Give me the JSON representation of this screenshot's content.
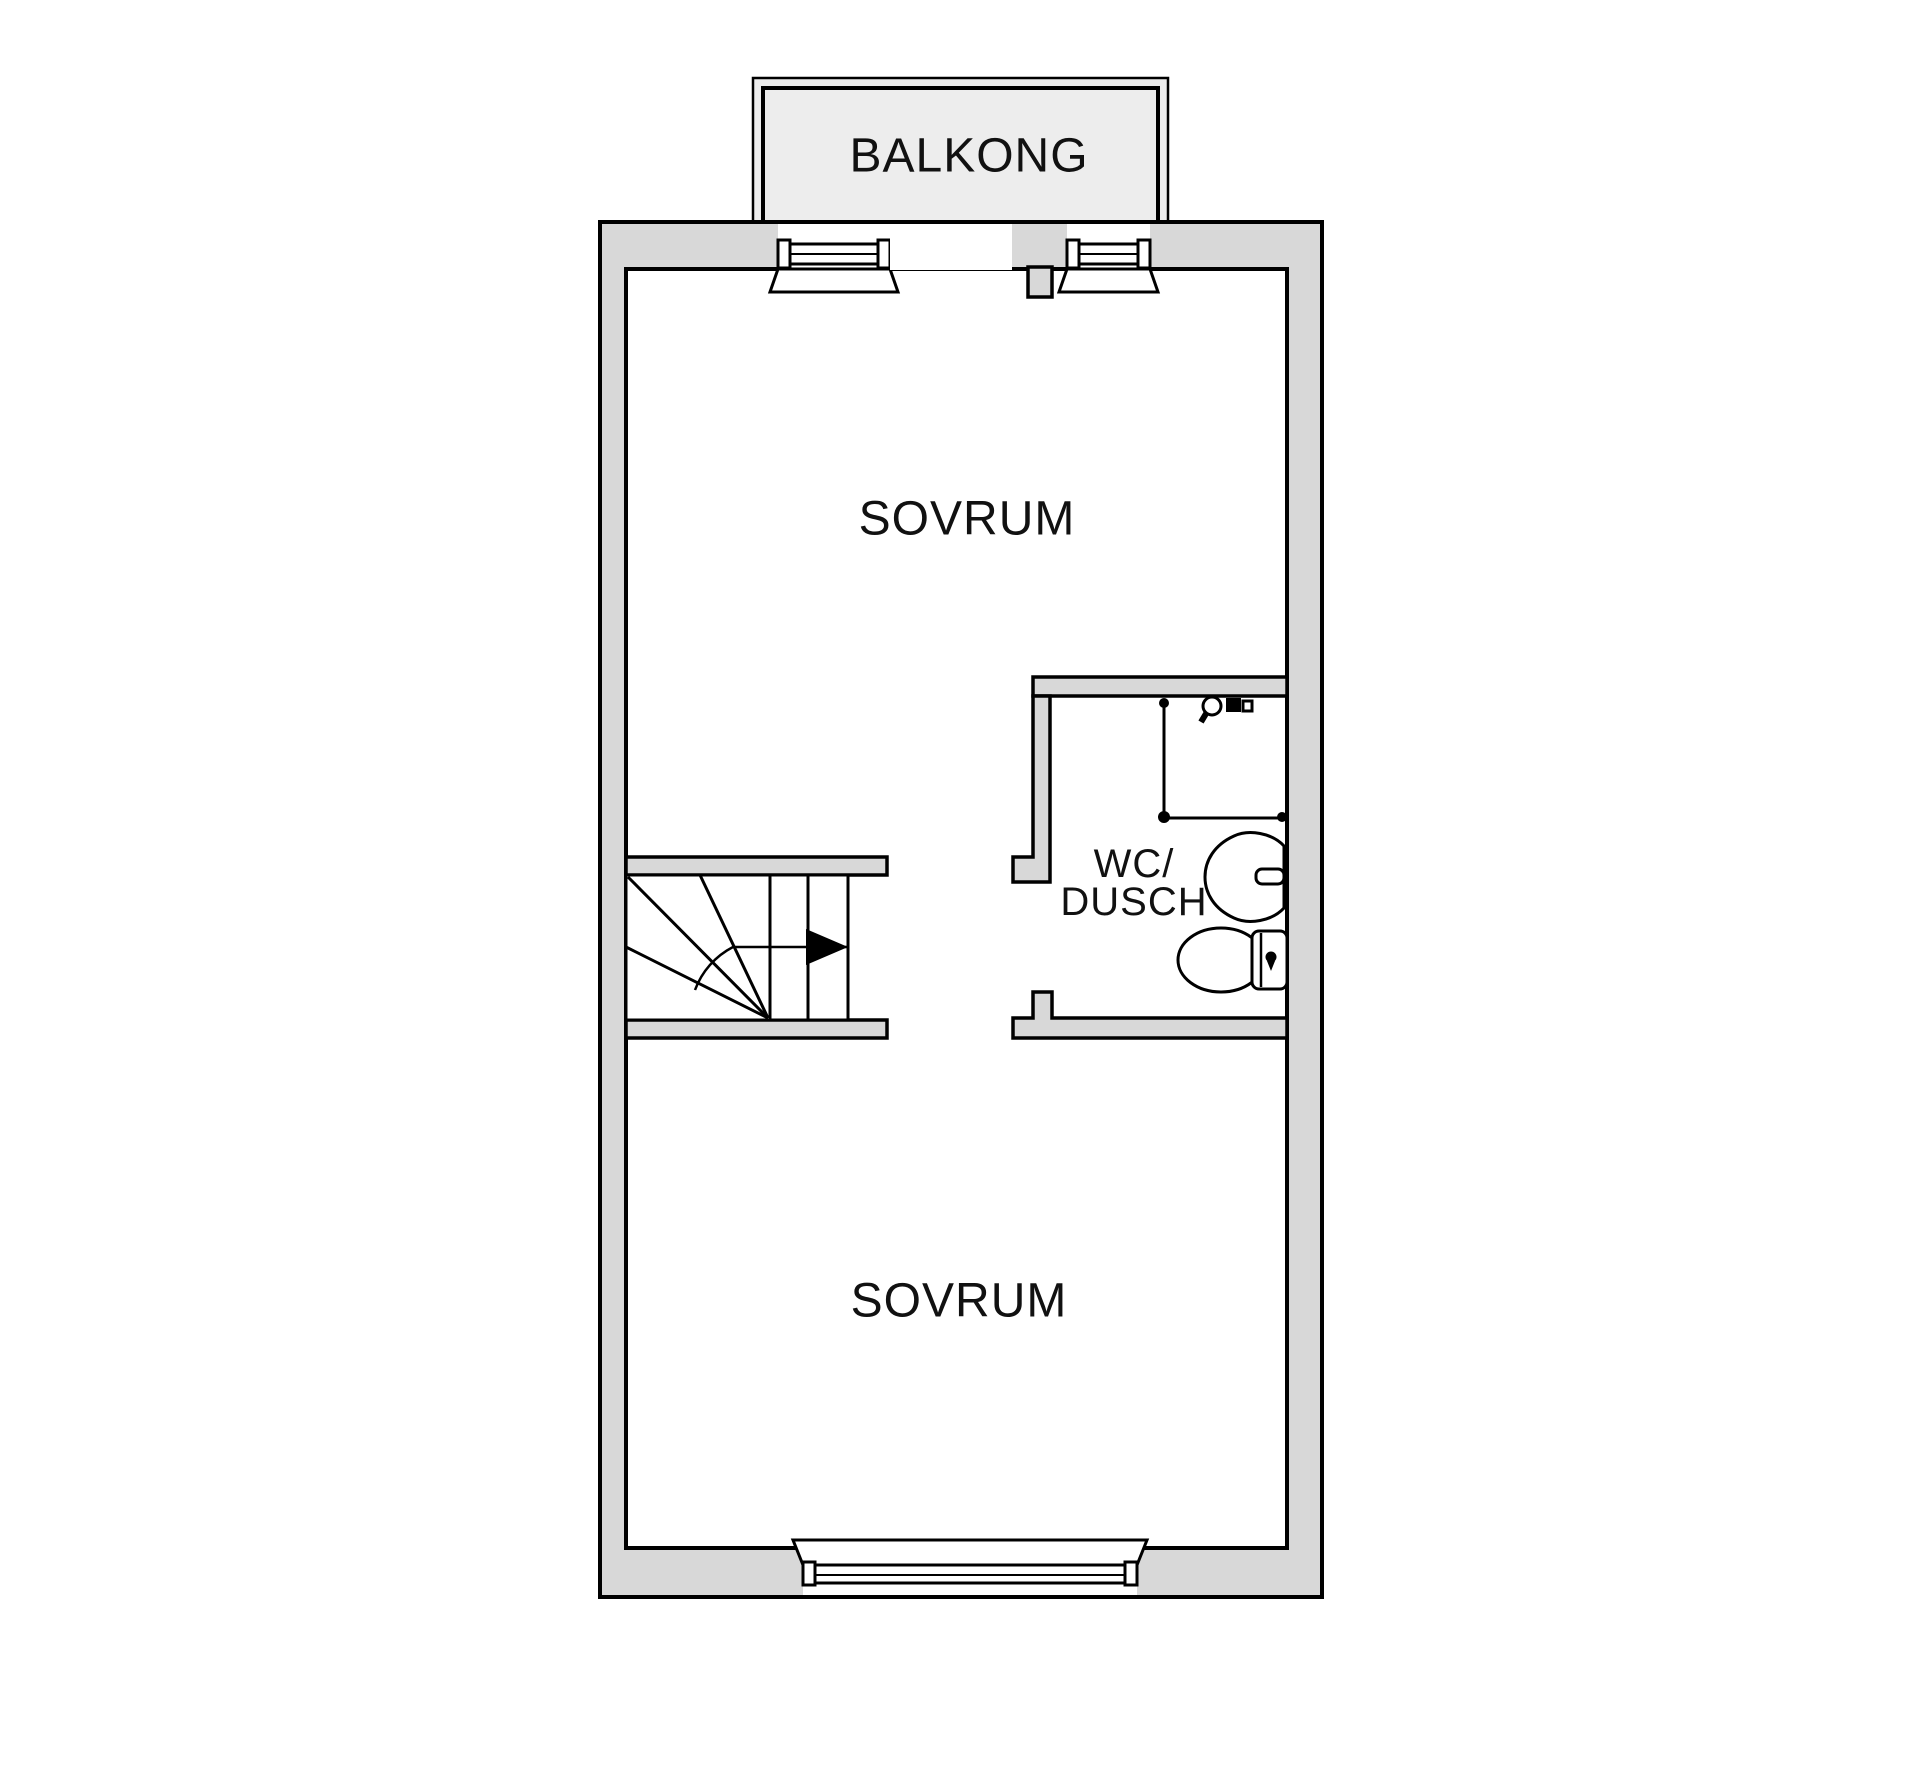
{
  "plan": {
    "balcony_label": "BALKONG",
    "bedroom_upper_label": "SOVRUM",
    "bathroom_label_line1": "WC/",
    "bathroom_label_line2": "DUSCH",
    "bedroom_lower_label": "SOVRUM"
  },
  "colors": {
    "wall_fill": "#d8d8d8",
    "balcony_fill": "#ededed",
    "line": "#000000",
    "background": "#ffffff",
    "text": "#111111"
  },
  "fixtures": [
    "staircase-icon",
    "stair-direction-arrow-icon",
    "shower-enclosure-icon",
    "shower-mixer-icon",
    "washbasin-icon",
    "toilet-icon"
  ]
}
